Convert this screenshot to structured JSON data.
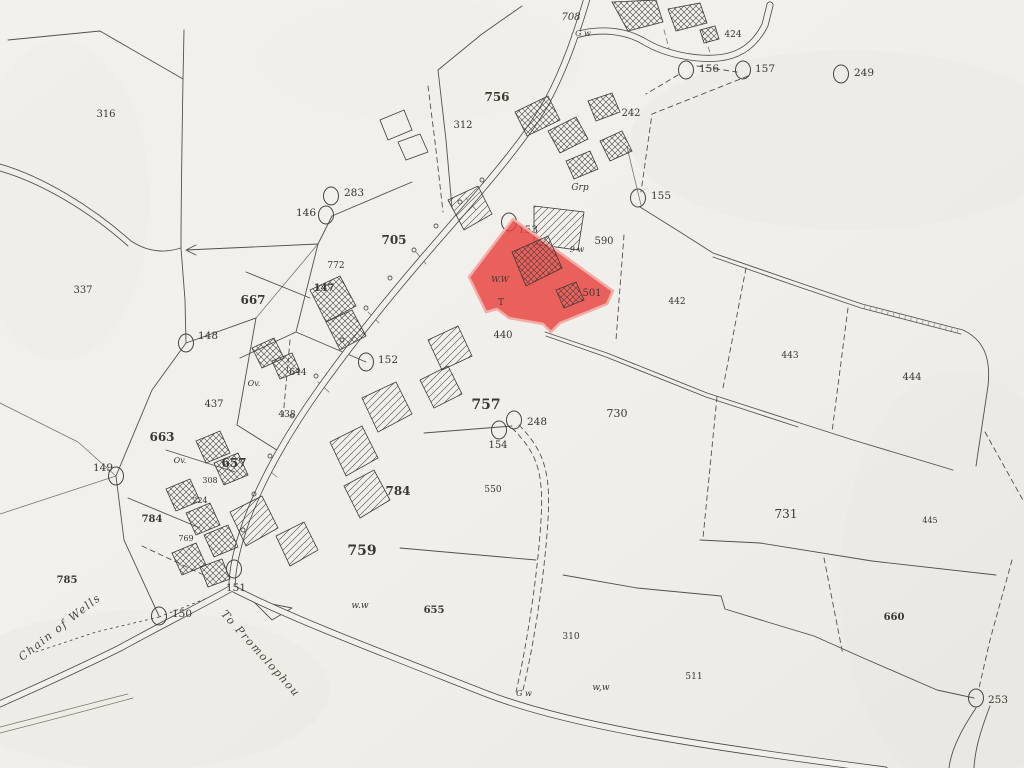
{
  "map": {
    "paper_color": "#f2f0ec",
    "ink_color": "#54504a",
    "highlighted_parcel": {
      "number": "501",
      "fill": "#e8413d",
      "fill_opacity": "0.82",
      "edge": "#f3aca6"
    },
    "parcel_labels": [
      {
        "text": "316",
        "x": 106,
        "y": 117
      },
      {
        "text": "337",
        "x": 83,
        "y": 293
      },
      {
        "text": "708",
        "x": 571,
        "y": 20,
        "italic": true
      },
      {
        "text": "756",
        "x": 497,
        "y": 101,
        "bold": true,
        "size": 12
      },
      {
        "text": "312",
        "x": 463,
        "y": 128
      },
      {
        "text": "242",
        "x": 631,
        "y": 116
      },
      {
        "text": "424",
        "x": 733,
        "y": 37,
        "size": 9
      },
      {
        "text": "705",
        "x": 394,
        "y": 244,
        "bold": true,
        "size": 12
      },
      {
        "text": "772",
        "x": 336,
        "y": 268,
        "size": 9
      },
      {
        "text": "147",
        "x": 324,
        "y": 291,
        "bold": true
      },
      {
        "text": "667",
        "x": 253,
        "y": 304,
        "bold": true,
        "size": 12
      },
      {
        "text": "590",
        "x": 604,
        "y": 244
      },
      {
        "text": "501",
        "x": 592,
        "y": 296
      },
      {
        "text": "440",
        "x": 503,
        "y": 338
      },
      {
        "text": "442",
        "x": 677,
        "y": 304,
        "size": 9
      },
      {
        "text": "443",
        "x": 790,
        "y": 358,
        "size": 9
      },
      {
        "text": "444",
        "x": 912,
        "y": 380
      },
      {
        "text": "437",
        "x": 214,
        "y": 407
      },
      {
        "text": "438",
        "x": 287,
        "y": 417,
        "size": 9
      },
      {
        "text": "644",
        "x": 298,
        "y": 375,
        "size": 9
      },
      {
        "text": "663",
        "x": 162,
        "y": 441,
        "bold": true,
        "size": 12
      },
      {
        "text": "657",
        "x": 234,
        "y": 467,
        "bold": true,
        "size": 12
      },
      {
        "text": "308",
        "x": 210,
        "y": 483,
        "size": 8
      },
      {
        "text": "224",
        "x": 200,
        "y": 503,
        "size": 8
      },
      {
        "text": "784",
        "x": 152,
        "y": 522,
        "bold": true
      },
      {
        "text": "769",
        "x": 186,
        "y": 541,
        "size": 8
      },
      {
        "text": "785",
        "x": 67,
        "y": 583,
        "bold": true
      },
      {
        "text": "757",
        "x": 486,
        "y": 409,
        "bold": true,
        "size": 14
      },
      {
        "text": "154",
        "x": 498,
        "y": 448
      },
      {
        "text": "550",
        "x": 493,
        "y": 492,
        "size": 9
      },
      {
        "text": "730",
        "x": 617,
        "y": 417,
        "size": 11
      },
      {
        "text": "731",
        "x": 786,
        "y": 518,
        "size": 12
      },
      {
        "text": "310",
        "x": 571,
        "y": 639,
        "size": 9
      },
      {
        "text": "511",
        "x": 694,
        "y": 679,
        "size": 9
      },
      {
        "text": "660",
        "x": 894,
        "y": 620,
        "bold": true
      },
      {
        "text": "445",
        "x": 930,
        "y": 523,
        "size": 8
      },
      {
        "text": "655",
        "x": 434,
        "y": 613,
        "bold": true
      },
      {
        "text": "759",
        "x": 362,
        "y": 555,
        "bold": true,
        "size": 14
      },
      {
        "text": "784",
        "x": 398,
        "y": 495,
        "bold": true,
        "size": 12
      },
      {
        "text": "Grp",
        "x": 580,
        "y": 190,
        "size": 9,
        "italic": true
      },
      {
        "text": "w.w",
        "x": 360,
        "y": 608,
        "size": 9,
        "italic": true
      },
      {
        "text": "W.W",
        "x": 500,
        "y": 282,
        "size": 8,
        "italic": true
      },
      {
        "text": "T",
        "x": 501,
        "y": 305,
        "size": 9
      },
      {
        "text": "w,w",
        "x": 601,
        "y": 690,
        "size": 9,
        "italic": true
      },
      {
        "text": "G w",
        "x": 524,
        "y": 696,
        "size": 8,
        "italic": true
      },
      {
        "text": "G w",
        "x": 583,
        "y": 36,
        "size": 8,
        "italic": true
      },
      {
        "text": "9 w",
        "x": 577,
        "y": 252,
        "size": 8,
        "italic": true
      },
      {
        "text": "Ov.",
        "x": 254,
        "y": 386,
        "size": 8,
        "italic": true
      },
      {
        "text": "Ov.",
        "x": 180,
        "y": 463,
        "size": 8,
        "italic": true
      }
    ],
    "markers": [
      {
        "label": "283",
        "cx": 331,
        "cy": 196,
        "tx": 344,
        "ty": 196
      },
      {
        "label": "146",
        "cx": 326,
        "cy": 215,
        "tx": 296,
        "ty": 216
      },
      {
        "label": "148",
        "cx": 186,
        "cy": 343,
        "tx": 198,
        "ty": 339
      },
      {
        "label": "149",
        "cx": 116,
        "cy": 476,
        "tx": 93,
        "ty": 471
      },
      {
        "label": "150",
        "cx": 159,
        "cy": 616,
        "tx": 172,
        "ty": 617
      },
      {
        "label": "151",
        "cx": 234,
        "cy": 569,
        "tx": 226,
        "ty": 591
      },
      {
        "label": "152",
        "cx": 366,
        "cy": 362,
        "tx": 378,
        "ty": 363
      },
      {
        "label": "153",
        "cx": 509,
        "cy": 222,
        "tx": 518,
        "ty": 233
      },
      {
        "label": "155",
        "cx": 638,
        "cy": 198,
        "tx": 651,
        "ty": 199
      },
      {
        "label": "156",
        "cx": 686,
        "cy": 70,
        "tx": 699,
        "ty": 72
      },
      {
        "label": "157",
        "cx": 743,
        "cy": 70,
        "tx": 755,
        "ty": 72
      },
      {
        "label": "248",
        "cx": 514,
        "cy": 420,
        "tx": 527,
        "ty": 425
      },
      {
        "label": "",
        "cx": 499,
        "cy": 430,
        "tx": 0,
        "ty": 0
      },
      {
        "label": "249",
        "cx": 841,
        "cy": 74,
        "tx": 854,
        "ty": 76
      },
      {
        "label": "253",
        "cx": 976,
        "cy": 698,
        "tx": 988,
        "ty": 703
      }
    ],
    "road_names": [
      {
        "text": "Chain of Wells",
        "x": 62,
        "y": 630,
        "rotate": -38,
        "size": 11
      },
      {
        "text": "To Promolophou",
        "x": 258,
        "y": 656,
        "rotate": 48,
        "size": 11
      }
    ]
  }
}
